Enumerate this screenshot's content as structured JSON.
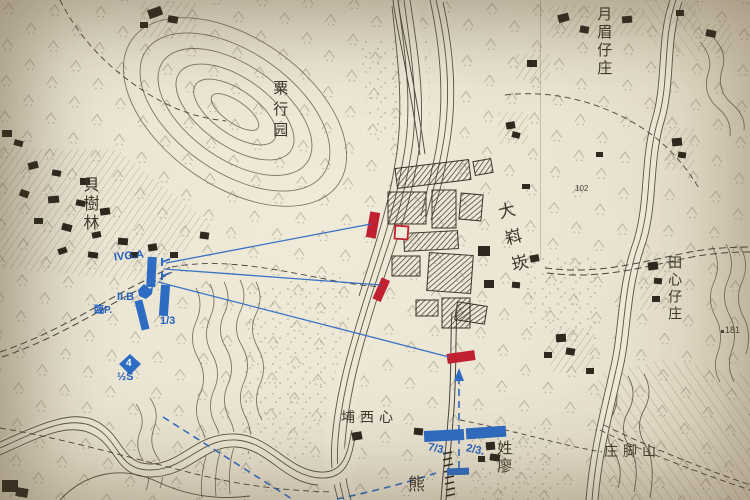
{
  "map": {
    "places": {
      "yuemei": "月眉仔庄",
      "suhangyuan": "粟行园",
      "beishulin": "貝樹林",
      "dakekan": "大嵙崁",
      "tianxin": "田心仔庄",
      "zhuangjiaoshan": "庄脚山",
      "xingliao": "姓廖",
      "puxixin": "埔西心",
      "xiong": "熊"
    },
    "elevations": {
      "e102": "102",
      "e181": "181"
    },
    "blue_units": {
      "ivga": "IVG.A",
      "iib": "II.B",
      "rin_p": "臨P.",
      "c13": "1/3",
      "sq4": "4",
      "half_s": "½S",
      "c73": "7/3.",
      "c23": "2/3."
    },
    "colors": {
      "friendly_blue": "#2e6cc4",
      "enemy_red": "#c0202f",
      "paper": "#eae4d2",
      "ink": "#4a4236"
    }
  }
}
